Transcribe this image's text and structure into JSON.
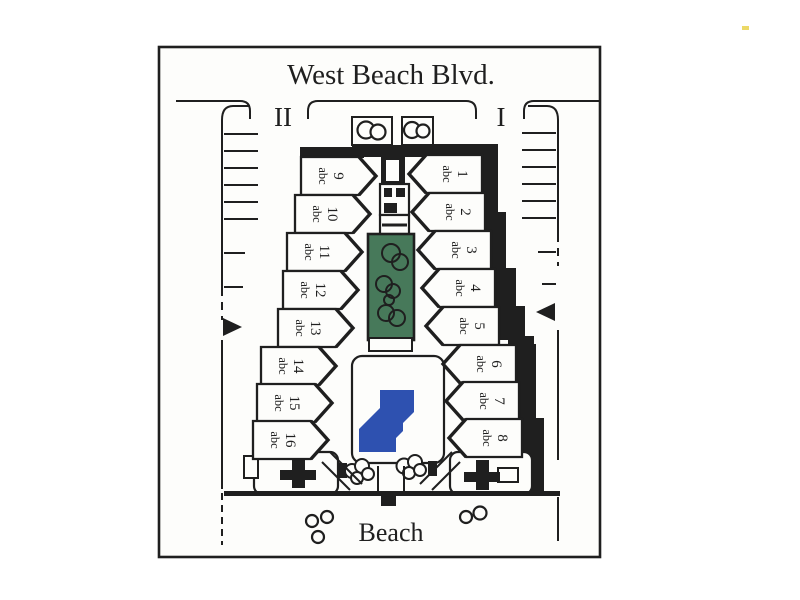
{
  "plan": {
    "street_label": "West Beach Blvd.",
    "beach_label": "Beach",
    "parking_left_label": "II",
    "parking_right_label": "I"
  },
  "units_left": [
    {
      "number": "9",
      "sub": "abc"
    },
    {
      "number": "10",
      "sub": "abc"
    },
    {
      "number": "11",
      "sub": "abc"
    },
    {
      "number": "12",
      "sub": "abc"
    },
    {
      "number": "13",
      "sub": "abc"
    },
    {
      "number": "14",
      "sub": "abc"
    },
    {
      "number": "15",
      "sub": "abc"
    },
    {
      "number": "16",
      "sub": "abc"
    }
  ],
  "units_right": [
    {
      "number": "1",
      "sub": "abc"
    },
    {
      "number": "2",
      "sub": "abc"
    },
    {
      "number": "3",
      "sub": "abc"
    },
    {
      "number": "4",
      "sub": "abc"
    },
    {
      "number": "5",
      "sub": "abc"
    },
    {
      "number": "6",
      "sub": "abc"
    },
    {
      "number": "7",
      "sub": "abc"
    },
    {
      "number": "8",
      "sub": "abc"
    }
  ],
  "colors": {
    "line": "#1f1f1f",
    "paper": "#fdfdfb",
    "garden_green": "#47795a",
    "pool_blue": "#2e51b0",
    "speck_yellow": "#e9d24c"
  }
}
